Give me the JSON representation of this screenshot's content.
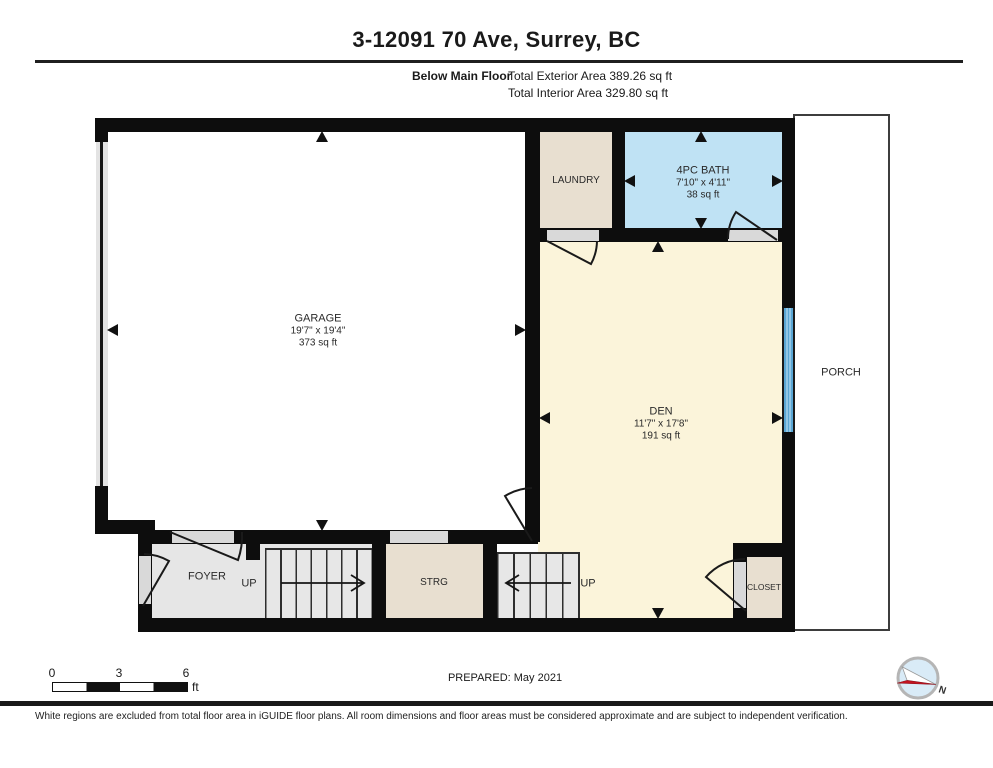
{
  "header": {
    "title": "3-12091 70 Ave, Surrey, BC",
    "floor_label": "Below Main Floor",
    "exterior_area": "Total Exterior Area 389.26 sq ft",
    "interior_area": "Total Interior Area 329.80 sq ft"
  },
  "rooms": {
    "garage": {
      "name": "GARAGE",
      "dims": "19'7\" x 19'4\"",
      "area": "373 sq ft"
    },
    "laundry": {
      "name": "LAUNDRY"
    },
    "bath": {
      "name": "4PC BATH",
      "dims": "7'10\" x 4'11\"",
      "area": "38 sq ft"
    },
    "den": {
      "name": "DEN",
      "dims": "11'7\" x 17'8\"",
      "area": "191 sq ft"
    },
    "porch": {
      "name": "PORCH"
    },
    "foyer": {
      "name": "FOYER"
    },
    "storage": {
      "name": "STRG"
    },
    "closet": {
      "name": "CLOSET"
    },
    "stairs_up_left": "UP",
    "stairs_up_right": "UP"
  },
  "footer": {
    "scale_ticks": [
      "0",
      "3",
      "6"
    ],
    "scale_unit": "ft",
    "prepared": "PREPARED: May 2021",
    "compass_north": "N",
    "disclaimer": "White regions are excluded from total floor area in iGUIDE floor plans. All room dimensions and floor areas must be considered approximate and are subject to independent verification."
  },
  "colors": {
    "wall": "#0d0d0d",
    "room-beige": "#e8dfd0",
    "room-blue": "#bfe2f4",
    "room-cream": "#fbf4da",
    "floor-gray": "#e6e6e6",
    "opening-gray": "#d9d9d9",
    "window-blue": "#4f9fce",
    "compass-red": "#c41320"
  }
}
